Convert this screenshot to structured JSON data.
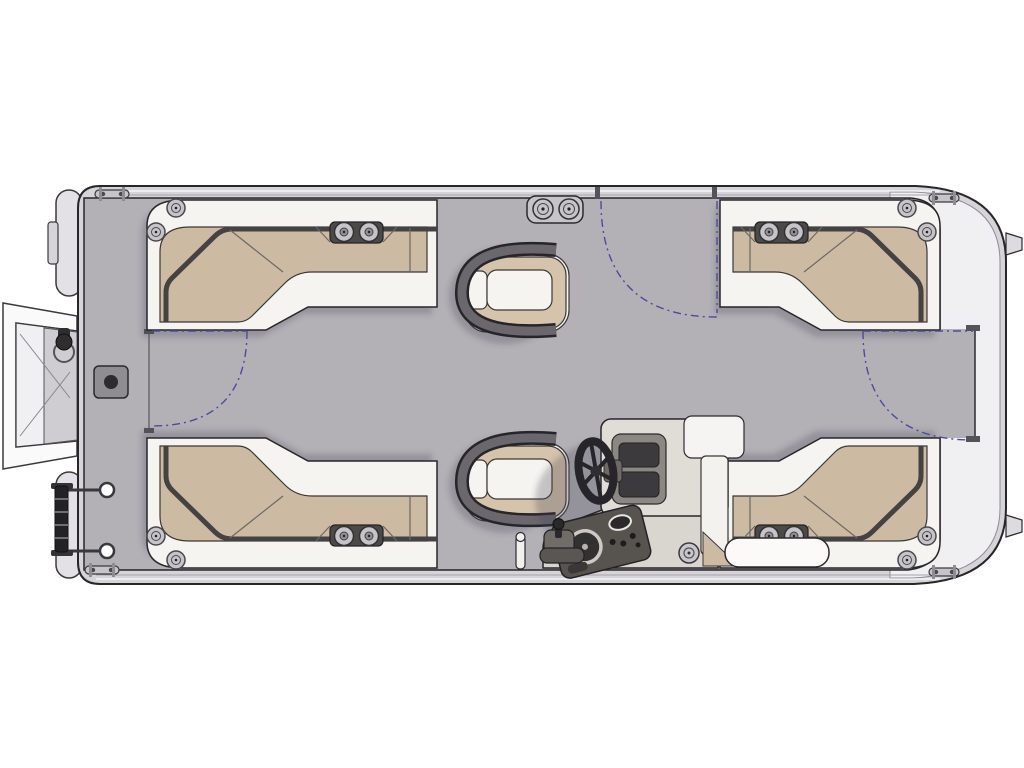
{
  "meta": {
    "title": "Pontoon boat floor plan (top-down line illustration)",
    "canvas": {
      "width": 1024,
      "height": 768
    },
    "visible_text": []
  },
  "colors": {
    "background": "#ffffff",
    "outline": "#27262a",
    "hull": "#d6d4d8",
    "hull_white_band": "#f0eff1",
    "hull_inner_line": "#8f8d93",
    "band_highlight": "#fbfbfc",
    "deck": "#b3b0b6",
    "seat_base": "#f6f4f0",
    "cushion": "#cdbaa2",
    "cushion_trim": "#454244",
    "seam": "#6b6965",
    "tray_dark": "#4c4a48",
    "metal": "#c6c4c8",
    "metal_dark": "#8f8d91",
    "metal_stroke": "#4a484c",
    "arm_gray": "#6a676d",
    "arm_dark": "#26252a",
    "chair_tan": "#d6c3ab",
    "console_body": "#e0dcd6",
    "console_skirt": "#d9d5cf",
    "panel_dark": "#57544f",
    "gate_dash": "#4c4c9c",
    "ladder_black": "#232225",
    "pad_gray": "#8f8d91",
    "shadow": "rgba(70,68,80,0.28)"
  },
  "components": {
    "hull": "pontoon hull and rub-rail outline",
    "deck": "main gray deck",
    "swim_platform": "boarding platform extending off left (stern) end",
    "boarding_ladder": "stowed ladder with grab handles, lower left",
    "lounge_stern_port": "L-shaped lounge, upper left",
    "lounge_stern_starboard": "L-shaped lounge, lower left",
    "lounge_bow_port": "L-shaped lounge, upper right",
    "lounge_bow_starboard": "L-shaped lounge, lower right",
    "captain_chair_port": "swivel captain chair, top center",
    "helm_chair": "swivel helm chair, bottom center",
    "helm_console": "helm console with windshield, instrument panel and throttle",
    "steering_wheel": "steering wheel",
    "cup_holder_pod": "twin cup holder pod on top rail",
    "cup_holder_trays": 4,
    "corner_speakers": 8,
    "gates": [
      "port side gate swing (top)",
      "bow gate swing (right)",
      "stern gate swing (left)"
    ],
    "cleats": 4,
    "deck_pad": "square access plate on left walkway",
    "ski_pylon": "small pole near bottom center",
    "motor_tabs": "two transom tabs on far right edge"
  }
}
